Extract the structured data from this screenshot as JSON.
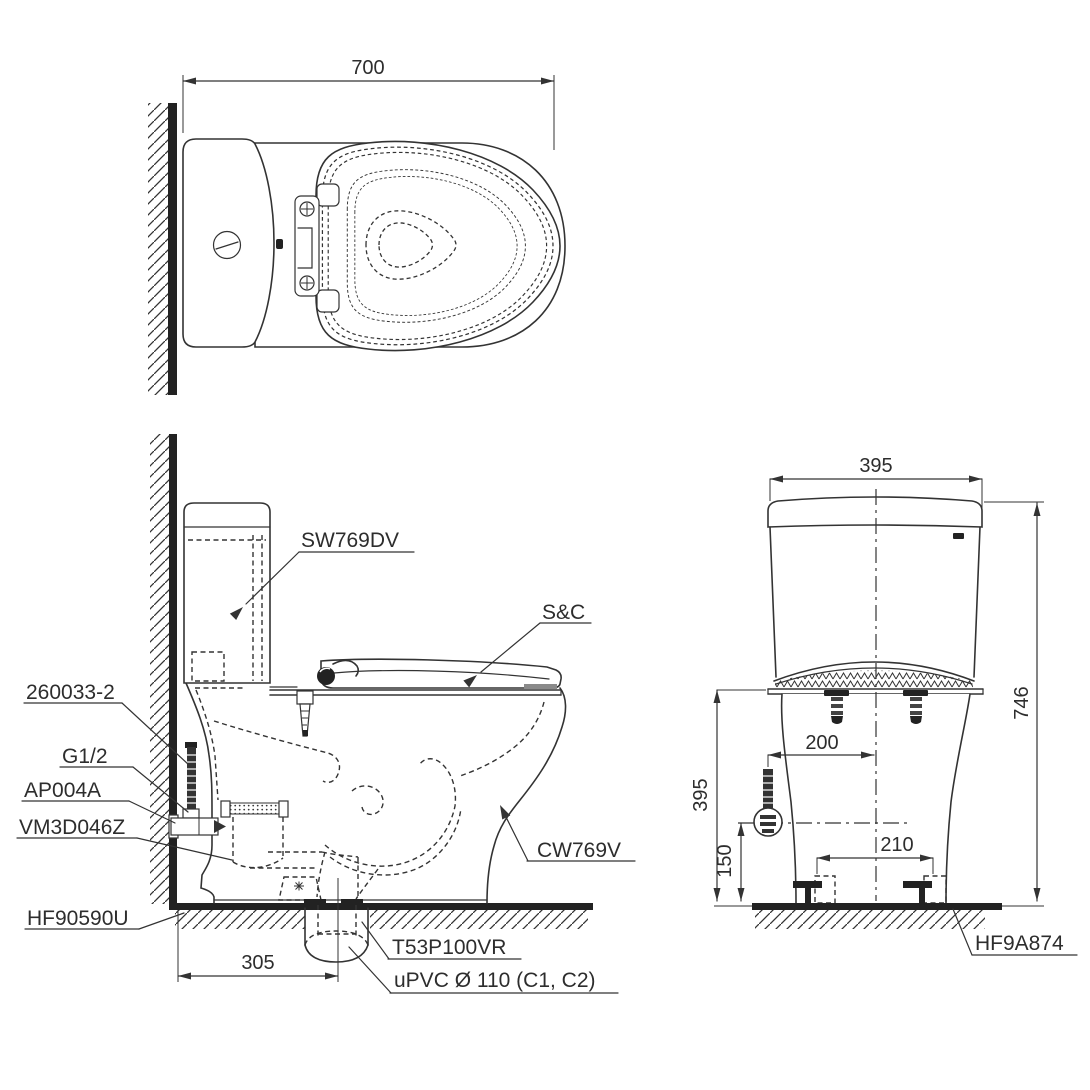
{
  "drawing": {
    "background": "#ffffff",
    "line_color": "#333333",
    "wall_fill": "#222222",
    "bumper_gray": "#8a8a8a",
    "views": {
      "top": {
        "depth_dim": "700"
      },
      "side": {
        "tank": "SW769DV",
        "seat_cover": "S&C",
        "bowl": "CW769V",
        "wall_supply": "260033-2",
        "thread_size": "G1/2",
        "stop_valve": "AP004A",
        "flush_fitting": "VM3D046Z",
        "floor_seal": "HF90590U",
        "outlet_flange": "T53P100VR",
        "drain_pipe": "uPVC Ø 110 (C1, C2)",
        "outlet_offset_dim": "305"
      },
      "front": {
        "tank_width_dim": "395",
        "total_height_dim": "746",
        "supply_offset_dim": "200",
        "rim_height_dim": "395",
        "supply_height_dim": "150",
        "bolt_pitch_dim": "210",
        "floor_flange": "HF9A874"
      }
    }
  }
}
